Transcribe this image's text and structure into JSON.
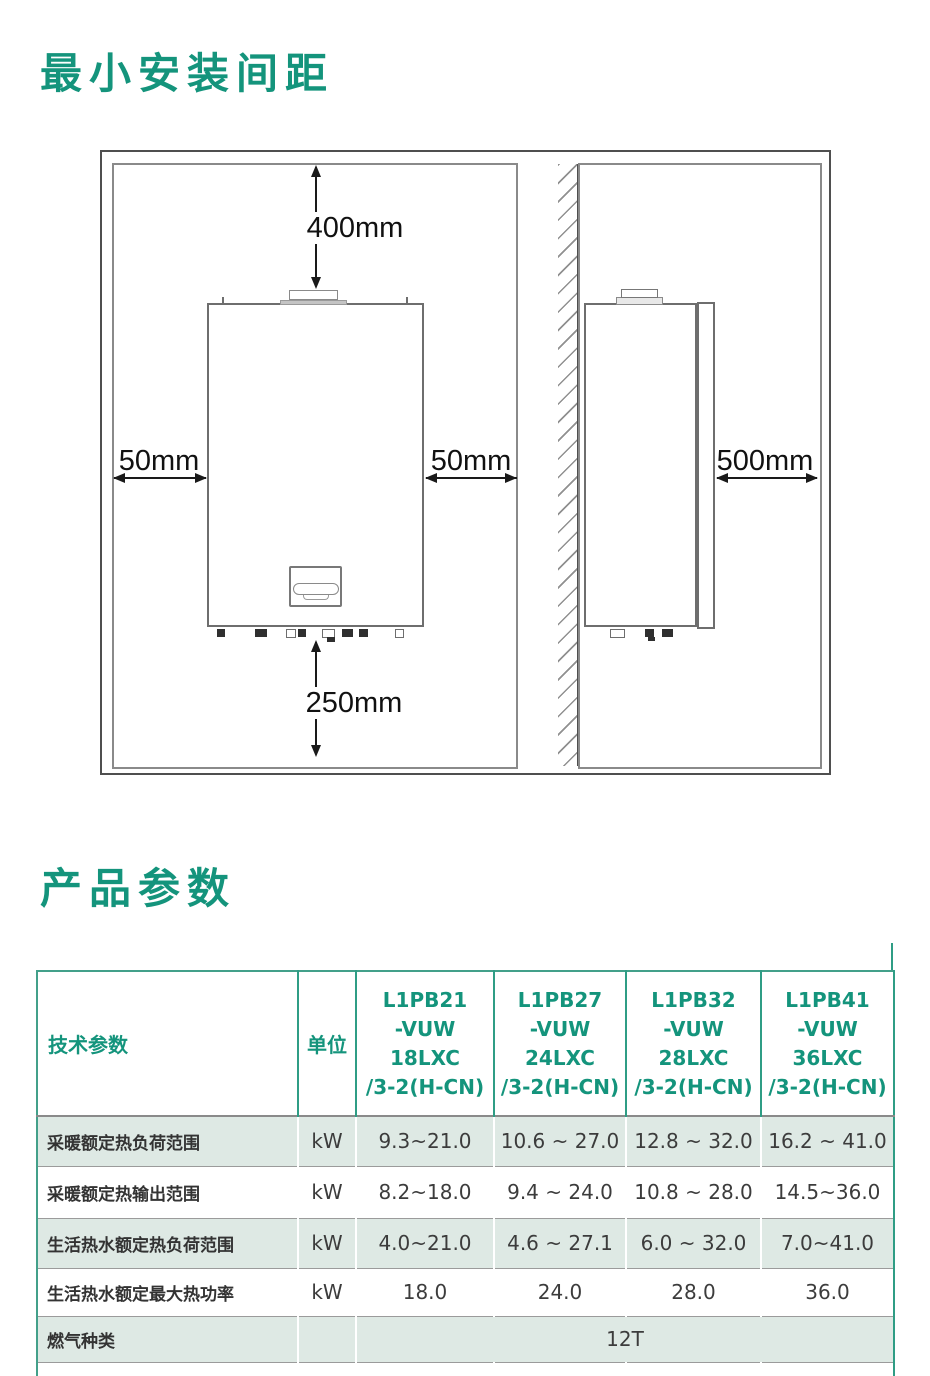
{
  "sections": {
    "installation_title": "最小安装间距",
    "parameters_title": "产品参数"
  },
  "diagram": {
    "top_clearance": "400mm",
    "left_clearance": "50mm",
    "right_clearance": "50mm",
    "front_clearance": "500mm",
    "bottom_clearance": "250mm"
  },
  "table": {
    "param_header": "技术参数",
    "unit_header": "单位",
    "models": [
      "L1PB21\n-VUW\n18LXC\n/3-2(H-CN)",
      "L1PB27\n-VUW\n24LXC\n/3-2(H-CN)",
      "L1PB32\n-VUW\n28LXC\n/3-2(H-CN)",
      "L1PB41\n-VUW\n36LXC\n/3-2(H-CN)"
    ],
    "rows": [
      {
        "param": "采暖额定热负荷范围",
        "unit": "kW",
        "values": [
          "9.3~21.0",
          "10.6 ~ 27.0",
          "12.8 ~ 32.0",
          "16.2 ~ 41.0"
        ]
      },
      {
        "param": "采暖额定热输出范围",
        "unit": "kW",
        "values": [
          "8.2~18.0",
          "9.4 ~ 24.0",
          "10.8 ~ 28.0",
          "14.5~36.0"
        ]
      },
      {
        "param": "生活热水额定热负荷范围",
        "unit": "kW",
        "values": [
          "4.0~21.0",
          "4.6 ~ 27.1",
          "6.0 ~ 32.0",
          "7.0~41.0"
        ]
      },
      {
        "param": "生活热水额定最大热功率",
        "unit": "kW",
        "values": [
          "18.0",
          "24.0",
          "28.0",
          "36.0"
        ]
      },
      {
        "param": "燃气种类",
        "unit": "",
        "merged_value": "12T"
      }
    ],
    "colors": {
      "accent_teal": "#14947c",
      "row_mint": "#dee9e4",
      "text_dark": "#3c3c3c"
    }
  }
}
